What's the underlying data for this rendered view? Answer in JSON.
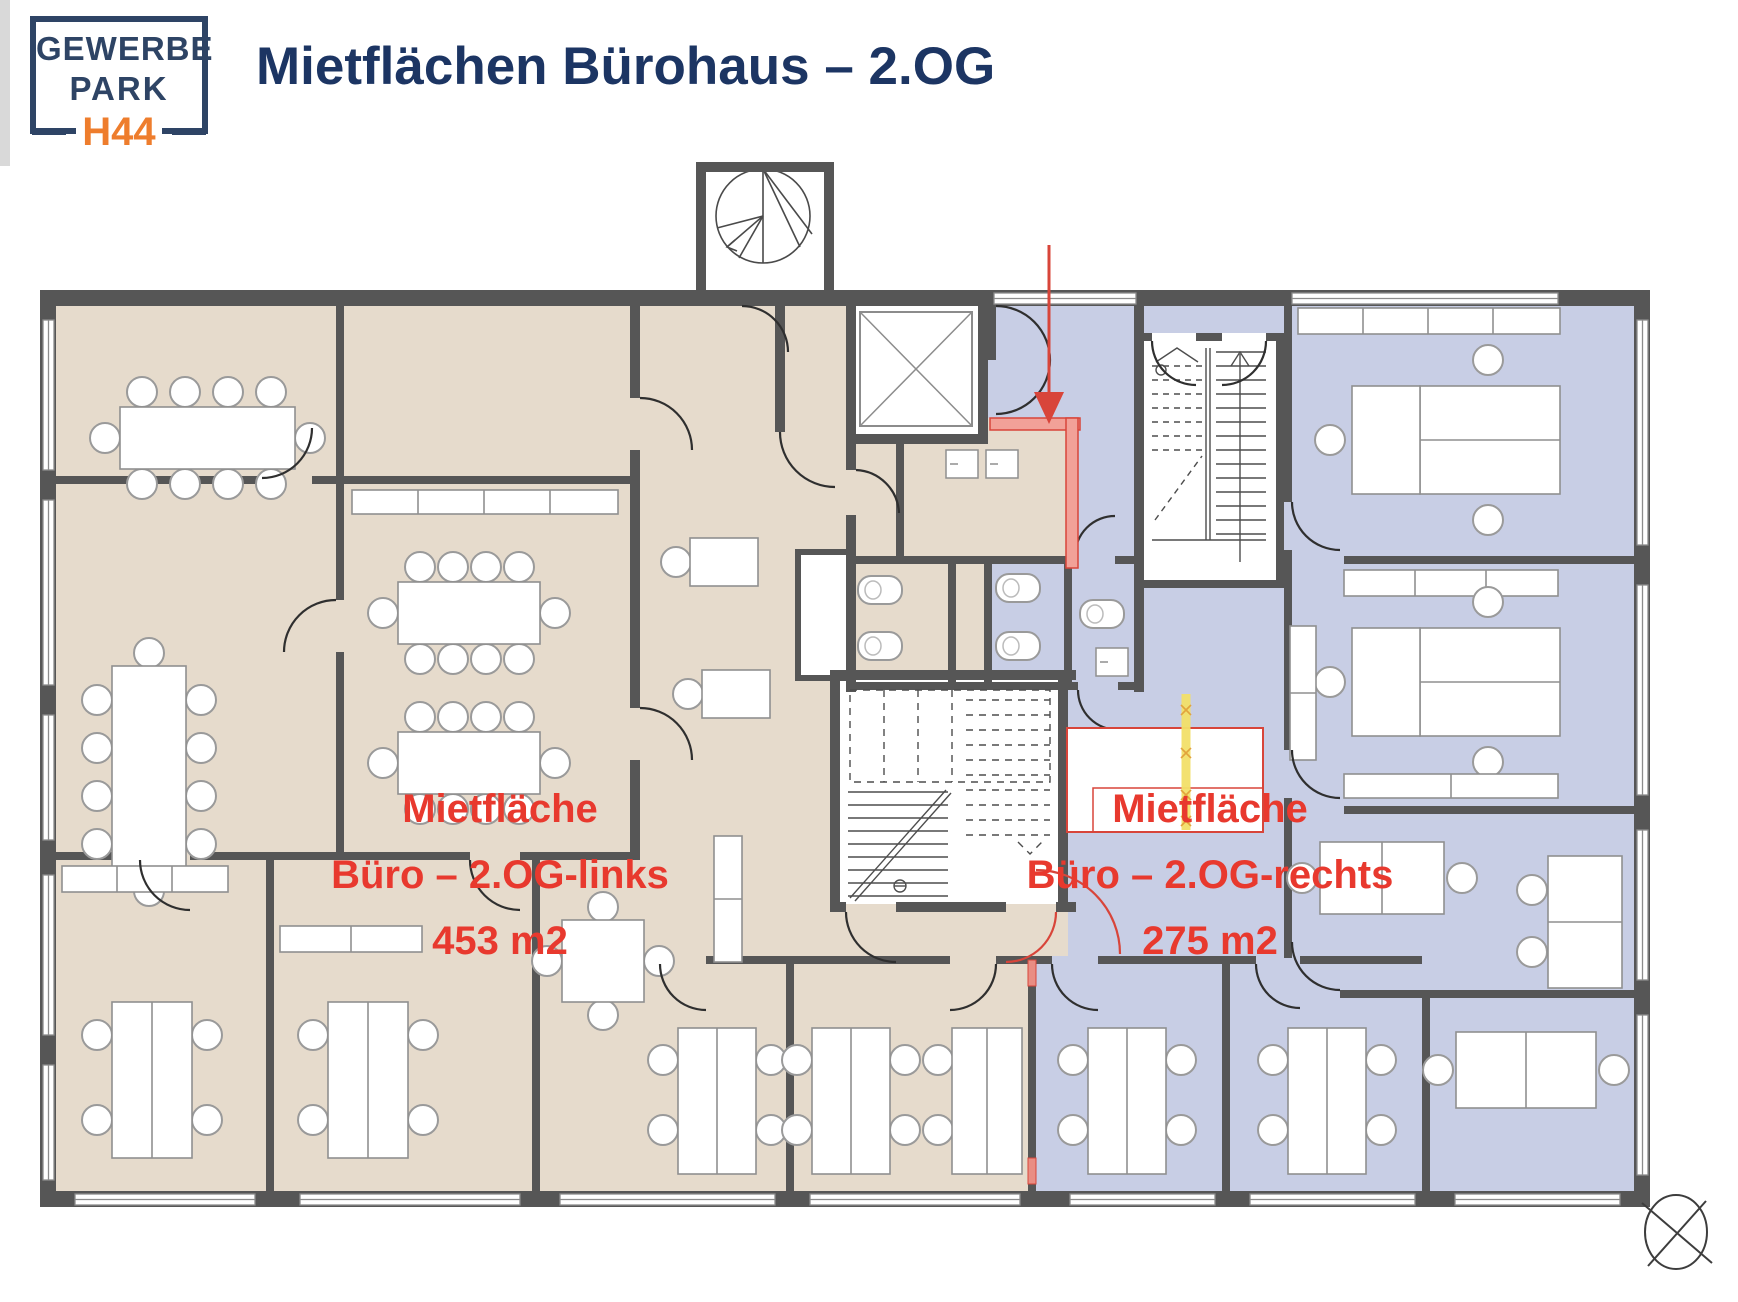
{
  "logo": {
    "line1": "GEWERBE",
    "line2": "PARK",
    "badge": "H44"
  },
  "header": {
    "title": "Mietflächen Bürohaus – 2.OG"
  },
  "areas": {
    "left": {
      "line1": "Mietfläche",
      "line2": "Büro – 2.OG-links",
      "line3": "453 m2",
      "fill_color": "#e6dbcc"
    },
    "right": {
      "line1": "Mietfläche",
      "line2": "Büro – 2.OG-rechts",
      "line3": "275 m2",
      "fill_color": "#c8cee5"
    }
  },
  "colors": {
    "accent_red": "#d8453a",
    "label_red": "#e8392e",
    "logo_navy": "#2e4465",
    "title_navy": "#1c3563",
    "badge_orange": "#ee7d2d",
    "wall_gray": "#565656",
    "highlight_yellow": "#f3e069"
  }
}
